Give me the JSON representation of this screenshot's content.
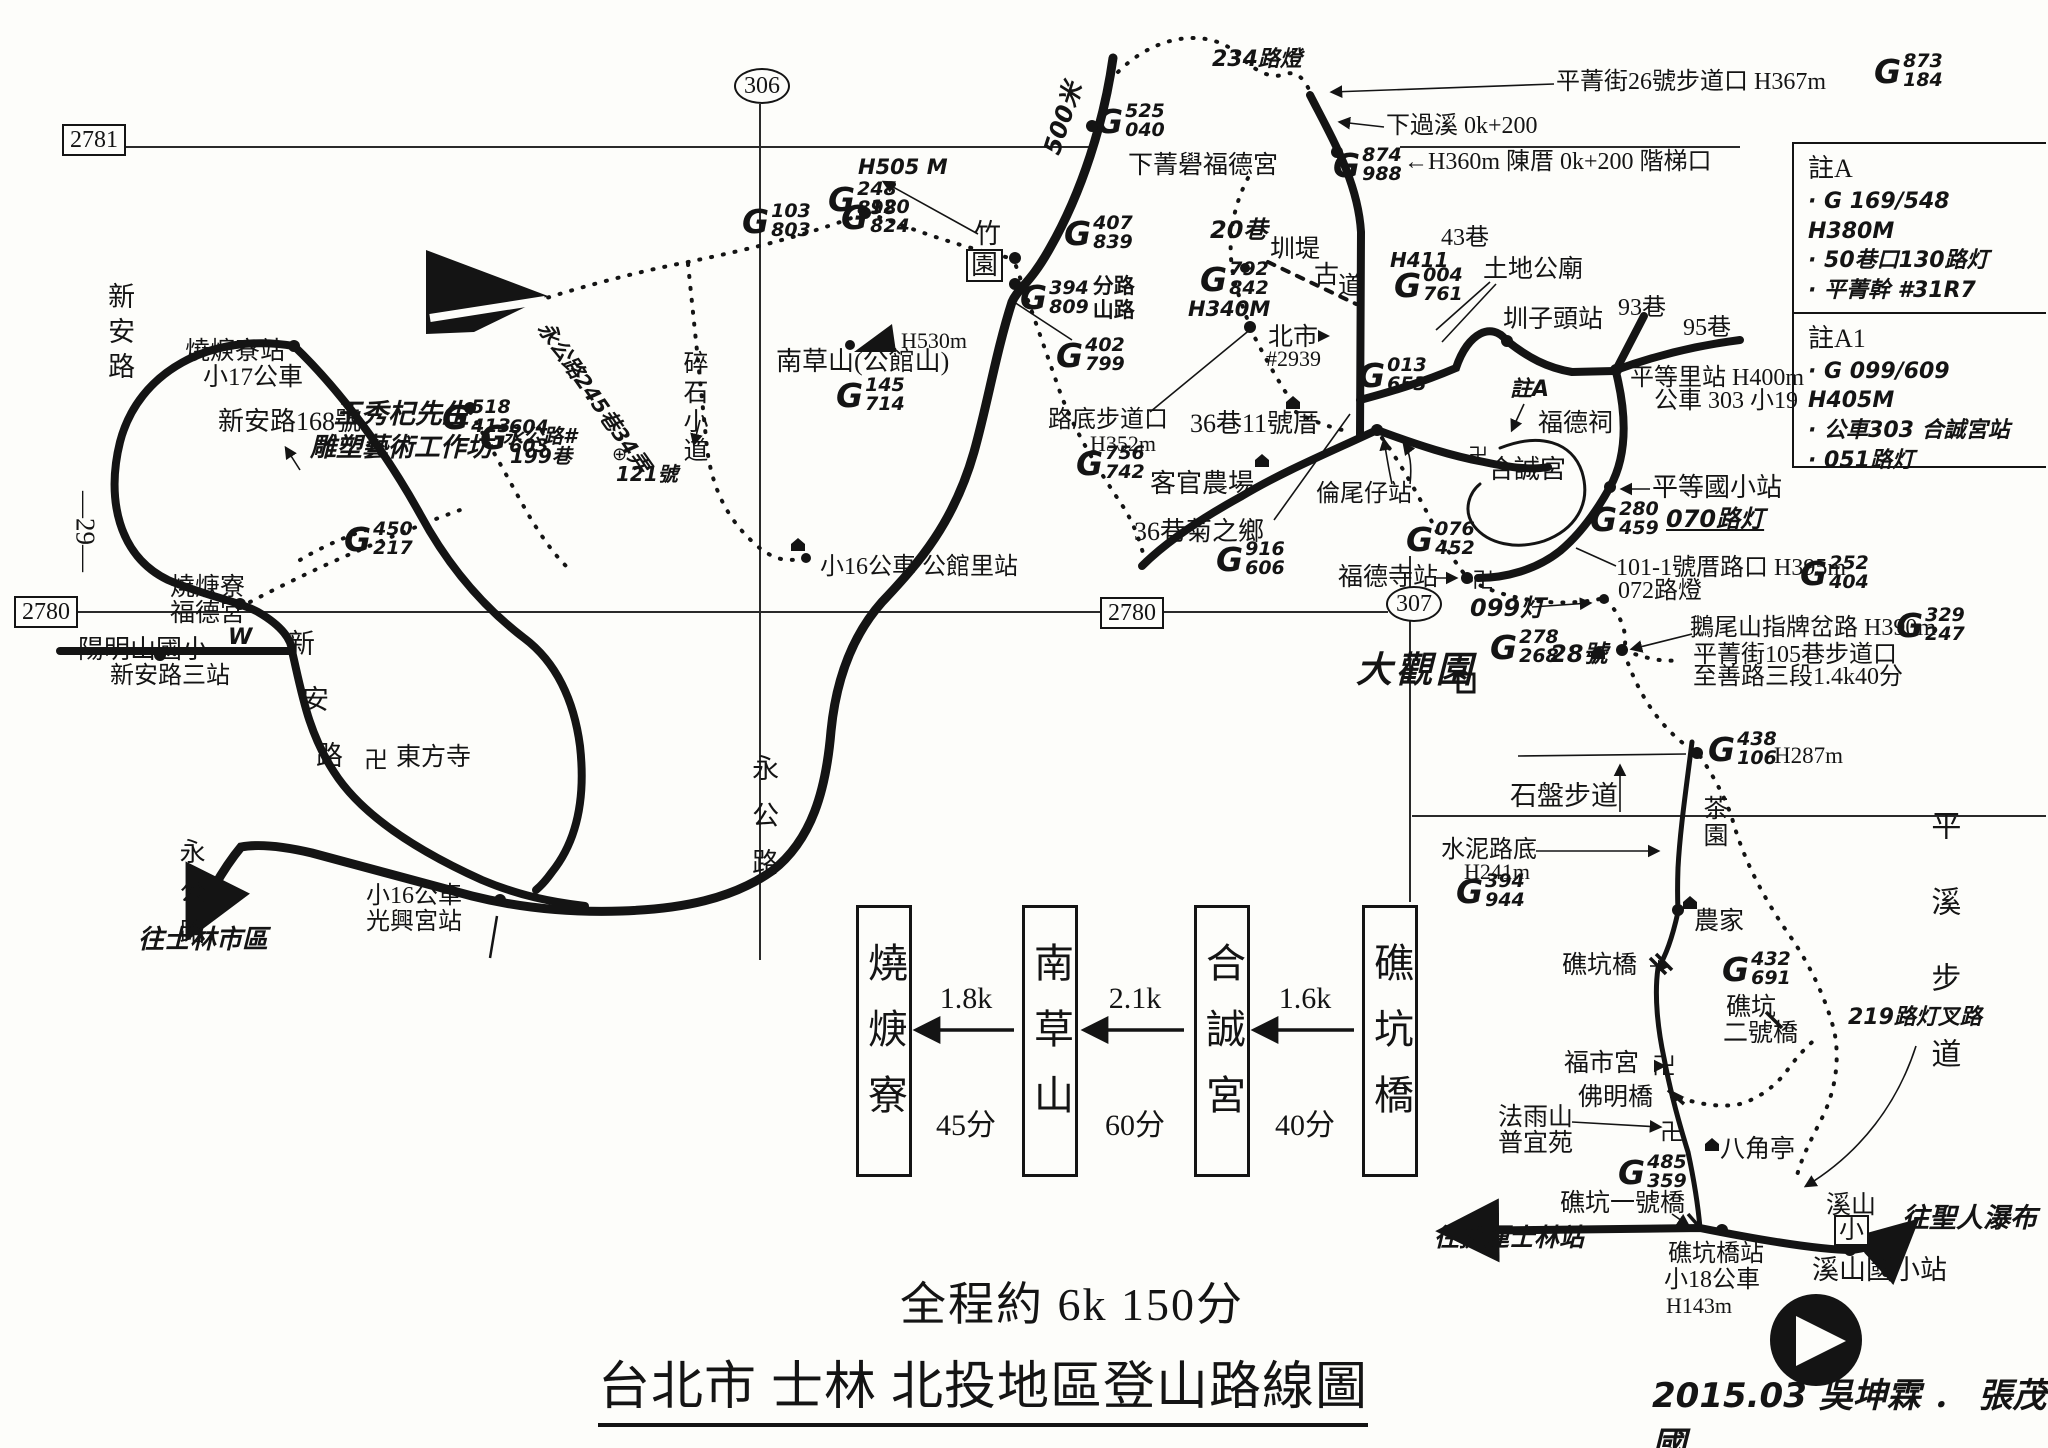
{
  "colors": {
    "ink": "#141414",
    "paper": "#fdfdfa"
  },
  "grid": {
    "top_left": "2781",
    "top_center": "306",
    "left": "2780",
    "center": "2780",
    "right": "307",
    "edge_left": "—29—"
  },
  "footer": {
    "total": "全程約 6k  150分",
    "title": "台北市 士林 北投地區登山路線圖",
    "signature": "2015.03  吳坤霖 ． 張茂國"
  },
  "notes": {
    "sections": [
      {
        "title": "註A",
        "items": [
          "G 169/548 H380M",
          "50巷口130路灯",
          "平菁幹 #31R7"
        ]
      },
      {
        "title": "註A1",
        "items": [
          "G 099/609 H405M",
          "公車303 合誠宮站",
          "051路灯"
        ]
      }
    ]
  },
  "route_diagram": {
    "stops": [
      "燒焿寮",
      "南草山",
      "合誠宮",
      "礁坑橋"
    ],
    "legs": [
      {
        "distance": "1.8k",
        "time": "45分"
      },
      {
        "distance": "2.1k",
        "time": "60分"
      },
      {
        "distance": "1.6k",
        "time": "40分"
      }
    ]
  },
  "gmark_prefix": "G",
  "gmarks": [
    {
      "id": "g873-184",
      "x": 1874,
      "y": 52,
      "top": "873",
      "bottom": "184"
    },
    {
      "id": "g525-040",
      "x": 1096,
      "y": 102,
      "top": "525",
      "bottom": "040"
    },
    {
      "id": "g874-988",
      "x": 1333,
      "y": 146,
      "top": "874",
      "bottom": "988"
    },
    {
      "id": "g248-898",
      "x": 828,
      "y": 180,
      "top": "248",
      "bottom": "898"
    },
    {
      "id": "g103-803",
      "x": 742,
      "y": 202,
      "top": "103",
      "bottom": "803"
    },
    {
      "id": "g120-824",
      "x": 841,
      "y": 198,
      "top": "120",
      "bottom": "824"
    },
    {
      "id": "g407-839",
      "x": 1064,
      "y": 214,
      "top": "407",
      "bottom": "839"
    },
    {
      "id": "g394-809",
      "x": 1020,
      "y": 274,
      "top": "394",
      "bottom": "809",
      "note": [
        "分路",
        "山路"
      ]
    },
    {
      "id": "g402-799",
      "x": 1056,
      "y": 336,
      "top": "402",
      "bottom": "799"
    },
    {
      "id": "g145-714",
      "x": 836,
      "y": 376,
      "top": "145",
      "bottom": "714"
    },
    {
      "id": "g792-842",
      "x": 1200,
      "y": 260,
      "top": "792",
      "bottom": "842"
    },
    {
      "id": "g004-761",
      "x": 1394,
      "y": 266,
      "top": "004",
      "bottom": "761"
    },
    {
      "id": "g013-653",
      "x": 1358,
      "y": 356,
      "top": "013",
      "bottom": "653"
    },
    {
      "id": "g756-742",
      "x": 1076,
      "y": 444,
      "top": "756",
      "bottom": "742"
    },
    {
      "id": "g916-606",
      "x": 1216,
      "y": 540,
      "top": "916",
      "bottom": "606"
    },
    {
      "id": "g076-452",
      "x": 1406,
      "y": 520,
      "top": "076",
      "bottom": "452"
    },
    {
      "id": "g280-459",
      "x": 1590,
      "y": 500,
      "top": "280",
      "bottom": "459"
    },
    {
      "id": "g252-404",
      "x": 1800,
      "y": 554,
      "top": "252",
      "bottom": "404"
    },
    {
      "id": "g329-247",
      "x": 1896,
      "y": 606,
      "top": "329",
      "bottom": "247"
    },
    {
      "id": "g278-268",
      "x": 1490,
      "y": 628,
      "top": "278",
      "bottom": "268"
    },
    {
      "id": "g438-106",
      "x": 1708,
      "y": 730,
      "top": "438",
      "bottom": "106"
    },
    {
      "id": "g394-944",
      "x": 1456,
      "y": 872,
      "top": "394",
      "bottom": "944"
    },
    {
      "id": "g432-691",
      "x": 1722,
      "y": 950,
      "top": "432",
      "bottom": "691"
    },
    {
      "id": "g485-359",
      "x": 1618,
      "y": 1153,
      "top": "485",
      "bottom": "359"
    },
    {
      "id": "g604-603",
      "x": 480,
      "y": 418,
      "top": "604",
      "bottom": "603"
    },
    {
      "id": "g518-413",
      "x": 442,
      "y": 398,
      "top": "518",
      "bottom": "413"
    },
    {
      "id": "g450-217",
      "x": 344,
      "y": 520,
      "top": "450",
      "bottom": "217"
    }
  ],
  "labels": [
    {
      "id": "shaokengliao-station",
      "text": "燒焿寮站",
      "x": 185,
      "y": 338,
      "fs": 25
    },
    {
      "id": "bus-17",
      "text": "小17公車",
      "x": 203,
      "y": 364,
      "fs": 25
    },
    {
      "id": "xinan-road-168",
      "text": "新安路168號",
      "x": 218,
      "y": 408,
      "fs": 26
    },
    {
      "id": "wang-xiuqi",
      "text": "王秀杞先生",
      "x": 334,
      "y": 400,
      "fs": 27,
      "cls": "hand"
    },
    {
      "id": "sculpture-studio",
      "text": "雕塑藝術工作坊",
      "x": 310,
      "y": 434,
      "fs": 26,
      "cls": "hand"
    },
    {
      "id": "shaokengliao-fudegong-1",
      "text": "燒焿寮",
      "x": 170,
      "y": 574,
      "fs": 25
    },
    {
      "id": "shaokengliao-fudegong-2",
      "text": "福德宮",
      "x": 170,
      "y": 600,
      "fs": 25
    },
    {
      "id": "w-mark",
      "text": "W",
      "x": 228,
      "y": 626,
      "fs": 22,
      "cls": "hand"
    },
    {
      "id": "xinan-road-vert",
      "text": "新安路",
      "x": 104,
      "y": 282,
      "fs": 27,
      "cls": "vert",
      "ls": 8
    },
    {
      "id": "xinan-road-char1",
      "text": "新",
      "x": 288,
      "y": 630,
      "fs": 27
    },
    {
      "id": "xinan-road-char2",
      "text": "安",
      "x": 302,
      "y": 686,
      "fs": 27
    },
    {
      "id": "xinan-road-char3",
      "text": "路",
      "x": 316,
      "y": 742,
      "fs": 27
    },
    {
      "id": "yangmingshan-elementary",
      "text": "陽明山國小",
      "x": 78,
      "y": 636,
      "fs": 26
    },
    {
      "id": "xinan-road-3rd-stop",
      "text": "新安路三站",
      "x": 110,
      "y": 664,
      "fs": 24
    },
    {
      "id": "dongfang-temple",
      "text": "東方寺",
      "x": 396,
      "y": 744,
      "fs": 25
    },
    {
      "id": "yonggong-road-sw",
      "text": "永公路",
      "x": 176,
      "y": 838,
      "fs": 26,
      "cls": "vert",
      "ls": 14
    },
    {
      "id": "bus-16-a",
      "text": "小16公車",
      "x": 366,
      "y": 884,
      "fs": 24
    },
    {
      "id": "guangxinggong-stop",
      "text": "光興宮站",
      "x": 366,
      "y": 910,
      "fs": 24
    },
    {
      "id": "to-shilin-downtown",
      "text": "往士林市區",
      "x": 138,
      "y": 926,
      "fs": 26,
      "cls": "hand"
    },
    {
      "id": "bus16-gongguanli-stop",
      "text": "小16公車 公館里站",
      "x": 820,
      "y": 555,
      "fs": 24
    },
    {
      "id": "yonggong-road-mid",
      "text": "永公路",
      "x": 748,
      "y": 754,
      "fs": 27,
      "cls": "vert",
      "ls": 20
    },
    {
      "id": "suishi-path",
      "text": "碎石小道",
      "x": 680,
      "y": 350,
      "fs": 25,
      "cls": "vert",
      "ls": 4
    },
    {
      "id": "nancaoshan",
      "text": "南草山(公館山)",
      "x": 776,
      "y": 348,
      "fs": 26
    },
    {
      "id": "h530",
      "text": "H530m",
      "x": 901,
      "y": 329,
      "fs": 22
    },
    {
      "id": "h505",
      "text": "H505 M",
      "x": 858,
      "y": 156,
      "fs": 21,
      "cls": "hand"
    },
    {
      "id": "zhu-char",
      "text": "竹",
      "x": 974,
      "y": 220,
      "fs": 27
    },
    {
      "id": "yuan-char",
      "text": "園",
      "x": 966,
      "y": 249,
      "fs": 27,
      "cls": "boxed"
    },
    {
      "id": "road-500m",
      "text": "500米",
      "x": 1040,
      "y": 150,
      "fs": 24,
      "cls": "hand",
      "rot": -72
    },
    {
      "id": "xiajingque-fudegong",
      "text": "下菁礐福德宮",
      "x": 1128,
      "y": 152,
      "fs": 25
    },
    {
      "id": "lamp-234",
      "text": "234路燈",
      "x": 1212,
      "y": 48,
      "fs": 22,
      "cls": "hand"
    },
    {
      "id": "pingjing-st-26-trailhead",
      "text": "平菁街26號步道口  H367m",
      "x": 1556,
      "y": 70,
      "fs": 24
    },
    {
      "id": "xiaguoxi",
      "text": "下過溪 0k+200",
      "x": 1386,
      "y": 114,
      "fs": 24
    },
    {
      "id": "chencuo-steps",
      "text": "←H360m 陳厝 0k+200 階梯口",
      "x": 1404,
      "y": 150,
      "fs": 24
    },
    {
      "id": "lane-20",
      "text": "20巷",
      "x": 1210,
      "y": 218,
      "fs": 24,
      "cls": "hand"
    },
    {
      "id": "zhundi",
      "text": "圳堤",
      "x": 1270,
      "y": 236,
      "fs": 25
    },
    {
      "id": "gudao-char1",
      "text": "古",
      "x": 1314,
      "y": 262,
      "fs": 25
    },
    {
      "id": "gudao-char2",
      "text": "道",
      "x": 1338,
      "y": 273,
      "fs": 25
    },
    {
      "id": "h411",
      "text": "H411",
      "x": 1390,
      "y": 250,
      "fs": 20,
      "cls": "hand"
    },
    {
      "id": "lane-43",
      "text": "43巷",
      "x": 1441,
      "y": 226,
      "fs": 24
    },
    {
      "id": "tudigong-temple",
      "text": "土地公廟",
      "x": 1483,
      "y": 256,
      "fs": 25
    },
    {
      "id": "zhunzitou-station",
      "text": "圳子頭站",
      "x": 1503,
      "y": 306,
      "fs": 25
    },
    {
      "id": "lane-93",
      "text": "93巷",
      "x": 1618,
      "y": 296,
      "fs": 24
    },
    {
      "id": "lane-95",
      "text": "95巷",
      "x": 1683,
      "y": 316,
      "fs": 24
    },
    {
      "id": "pingdengli-station",
      "text": "平等里站 H400m",
      "x": 1630,
      "y": 366,
      "fs": 24
    },
    {
      "id": "bus-303",
      "text": "公車 303 小19",
      "x": 1654,
      "y": 389,
      "fs": 24
    },
    {
      "id": "beishi",
      "text": "北市",
      "x": 1268,
      "y": 324,
      "fs": 25
    },
    {
      "id": "no-2939",
      "text": "#2939",
      "x": 1266,
      "y": 347,
      "fs": 22
    },
    {
      "id": "ludi-trailhead",
      "text": "路底步道口",
      "x": 1048,
      "y": 408,
      "fs": 24
    },
    {
      "id": "h352",
      "text": "H352m",
      "x": 1090,
      "y": 432,
      "fs": 22
    },
    {
      "id": "keguan-farm",
      "text": "客官農場",
      "x": 1150,
      "y": 470,
      "fs": 26
    },
    {
      "id": "lane36-house11",
      "text": "36巷11號厝",
      "x": 1190,
      "y": 410,
      "fs": 26
    },
    {
      "id": "lane36-juzhixiang",
      "text": "36巷菊之鄉",
      "x": 1134,
      "y": 518,
      "fs": 26
    },
    {
      "id": "lunweizi-station",
      "text": "倫尾仔站",
      "x": 1316,
      "y": 482,
      "fs": 24
    },
    {
      "id": "fude-shrine",
      "text": "福德祠",
      "x": 1538,
      "y": 410,
      "fs": 25
    },
    {
      "id": "note-a-ref",
      "text": "註A",
      "x": 1510,
      "y": 378,
      "fs": 22,
      "cls": "hand"
    },
    {
      "id": "hechenggong-temple",
      "text": "合誠宮",
      "x": 1488,
      "y": 456,
      "fs": 26
    },
    {
      "id": "pingdeng-elementary-stop",
      "text": "平等國小站",
      "x": 1652,
      "y": 474,
      "fs": 26
    },
    {
      "id": "lamp-070",
      "text": "070路灯",
      "x": 1666,
      "y": 507,
      "fs": 24,
      "cls": "hand underline"
    },
    {
      "id": "fudesi-station",
      "text": "福德寺站",
      "x": 1338,
      "y": 564,
      "fs": 25
    },
    {
      "id": "lamp-099",
      "text": "099灯",
      "x": 1470,
      "y": 596,
      "fs": 24,
      "cls": "hand"
    },
    {
      "id": "house-101-1",
      "text": "101-1號厝路口 H395m",
      "x": 1616,
      "y": 556,
      "fs": 24
    },
    {
      "id": "lamp-072",
      "text": "072路燈",
      "x": 1618,
      "y": 579,
      "fs": 24
    },
    {
      "id": "eweishan-junction",
      "text": "鵝尾山指牌岔路 H390m",
      "x": 1690,
      "y": 616,
      "fs": 24
    },
    {
      "id": "pingjing-st-105-trailhead",
      "text": "平菁街105巷步道口",
      "x": 1693,
      "y": 643,
      "fs": 24
    },
    {
      "id": "zhishan-road-sec3",
      "text": "至善路三段1.4k40分",
      "x": 1693,
      "y": 665,
      "fs": 24
    },
    {
      "id": "daguanyuan",
      "text": "大觀園",
      "x": 1356,
      "y": 652,
      "fs": 36,
      "cls": "hand bold",
      "ls": 4
    },
    {
      "id": "no-28",
      "text": "28號",
      "x": 1550,
      "y": 642,
      "fs": 24,
      "cls": "hand"
    },
    {
      "id": "shipan-trail",
      "text": "石盤步道",
      "x": 1510,
      "y": 782,
      "fs": 27
    },
    {
      "id": "chayuan-tea-garden",
      "text": "茶園",
      "x": 1700,
      "y": 795,
      "fs": 25,
      "cls": "vert",
      "ls": 2
    },
    {
      "id": "pingxi-trail",
      "text": "平溪步道",
      "x": 1926,
      "y": 810,
      "fs": 30,
      "cls": "vert",
      "ls": 46
    },
    {
      "id": "shuini-road-end",
      "text": "水泥路底",
      "x": 1441,
      "y": 838,
      "fs": 24
    },
    {
      "id": "h241",
      "text": "H241m",
      "x": 1464,
      "y": 860,
      "fs": 22
    },
    {
      "id": "nongjia-farmhouse",
      "text": "農家",
      "x": 1694,
      "y": 908,
      "fs": 25
    },
    {
      "id": "jiaokeng-bridge",
      "text": "礁坑橋",
      "x": 1562,
      "y": 952,
      "fs": 25
    },
    {
      "id": "jiaokeng-bridge2-a",
      "text": "礁坑",
      "x": 1726,
      "y": 994,
      "fs": 25
    },
    {
      "id": "jiaokeng-bridge2-b",
      "text": "二號橋",
      "x": 1723,
      "y": 1020,
      "fs": 25
    },
    {
      "id": "lamp-219",
      "text": "219路灯叉路",
      "x": 1848,
      "y": 1006,
      "fs": 22,
      "cls": "hand"
    },
    {
      "id": "fushigong-temple",
      "text": "福市宮",
      "x": 1564,
      "y": 1050,
      "fs": 25
    },
    {
      "id": "foming-bridge",
      "text": "佛明橋",
      "x": 1578,
      "y": 1084,
      "fs": 25
    },
    {
      "id": "fayushan-a",
      "text": "法雨山",
      "x": 1498,
      "y": 1104,
      "fs": 25
    },
    {
      "id": "fayushan-b",
      "text": "普宜苑",
      "x": 1498,
      "y": 1130,
      "fs": 25
    },
    {
      "id": "bajiaoting-pavilion",
      "text": "八角亭",
      "x": 1720,
      "y": 1136,
      "fs": 25
    },
    {
      "id": "jiaokeng-bridge1",
      "text": "礁坑一號橋",
      "x": 1560,
      "y": 1190,
      "fs": 25
    },
    {
      "id": "to-mrt-shilin",
      "text": "往捷運士林站",
      "x": 1434,
      "y": 1224,
      "fs": 25,
      "cls": "hand"
    },
    {
      "id": "jiaokengqiao-station",
      "text": "礁坑橋站",
      "x": 1668,
      "y": 1242,
      "fs": 24
    },
    {
      "id": "bus-18",
      "text": "小18公車",
      "x": 1664,
      "y": 1268,
      "fs": 24
    },
    {
      "id": "h143",
      "text": "H143m",
      "x": 1666,
      "y": 1294,
      "fs": 22
    },
    {
      "id": "xishan",
      "text": "溪山",
      "x": 1826,
      "y": 1192,
      "fs": 25
    },
    {
      "id": "xishan-xiao",
      "text": "小",
      "x": 1834,
      "y": 1215,
      "fs": 25,
      "cls": "boxed"
    },
    {
      "id": "to-shengren-waterfall",
      "text": "往聖人瀑布",
      "x": 1902,
      "y": 1204,
      "fs": 27,
      "cls": "hand"
    },
    {
      "id": "xishan-elementary-stop",
      "text": "溪山國小站",
      "x": 1812,
      "y": 1256,
      "fs": 27
    },
    {
      "id": "h287",
      "text": "H287m",
      "x": 1774,
      "y": 744,
      "fs": 23
    },
    {
      "id": "h340",
      "text": "H340M",
      "x": 1188,
      "y": 298,
      "fs": 21,
      "cls": "hand"
    },
    {
      "id": "yonggong-245-34",
      "text": "永公路245巷34弄",
      "x": 552,
      "y": 318,
      "fs": 21,
      "cls": "hand",
      "rot": 55
    },
    {
      "id": "yonggong-199-a",
      "text": "永公路#",
      "x": 503,
      "y": 426,
      "fs": 20,
      "cls": "hand"
    },
    {
      "id": "yonggong-199-b",
      "text": "199巷",
      "x": 510,
      "y": 446,
      "fs": 20,
      "cls": "hand"
    },
    {
      "id": "no-121",
      "text": "121號",
      "x": 616,
      "y": 464,
      "fs": 20,
      "cls": "hand"
    }
  ]
}
